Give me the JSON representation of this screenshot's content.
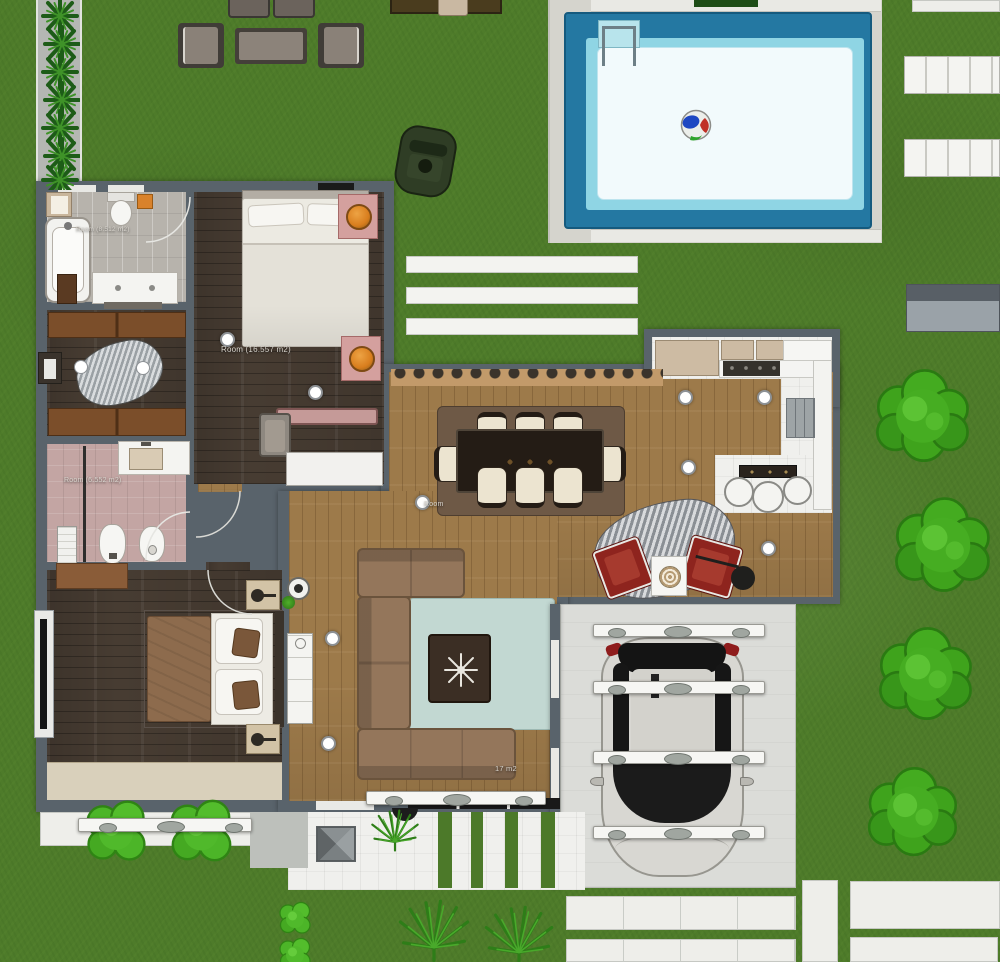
{
  "title": "house-floor-plan",
  "labels": {
    "bedroom_top": "Room (16.557 m2)",
    "bathroom_top": "Room (8.512 m2)",
    "bathroom_mid": "Room (6.552 m2)",
    "dining": "Room",
    "living": "17 m2"
  },
  "colors": {
    "grass": "#4e7b2a",
    "pool_border": "#2478a2",
    "pool_inner": "#8fd5e4",
    "pool_water": "#f2fafc",
    "wall": "#59636b",
    "wood_dark": "#473c32",
    "wood_light": "#9d7a4a",
    "tile_gray": "#b7b3ac",
    "bath_pink": "#c3a5a3",
    "paving_white": "#eeeeea",
    "tree_green": "#3fa31c",
    "pouf_orange": "#e08b28",
    "chair_red": "#8e241e",
    "rug_teal": "#c2d8d2"
  },
  "scene": {
    "rooms": [
      "bathroom-top",
      "walk-in-closet",
      "bathroom-middle",
      "bedroom-top",
      "bedroom-bottom",
      "living-room",
      "dining-room",
      "kitchen",
      "reading-nook",
      "carport-garage",
      "entry-terrace"
    ],
    "outdoor_objects": [
      "swimming-pool",
      "pool-ladder",
      "beach-ball",
      "sun-lounger",
      "sun-lounger",
      "garden-bench",
      "lounge-armchair",
      "lounge-armchair",
      "lounge-sofa",
      "lounge-sofa",
      "coffee-table",
      "picnic-table",
      "car-on-lawn",
      "car-in-garage",
      "pergola-beams",
      "agave-hedge",
      "tree",
      "tree",
      "tree",
      "tree",
      "bush",
      "bush",
      "palm",
      "palm",
      "paver-paths"
    ]
  }
}
